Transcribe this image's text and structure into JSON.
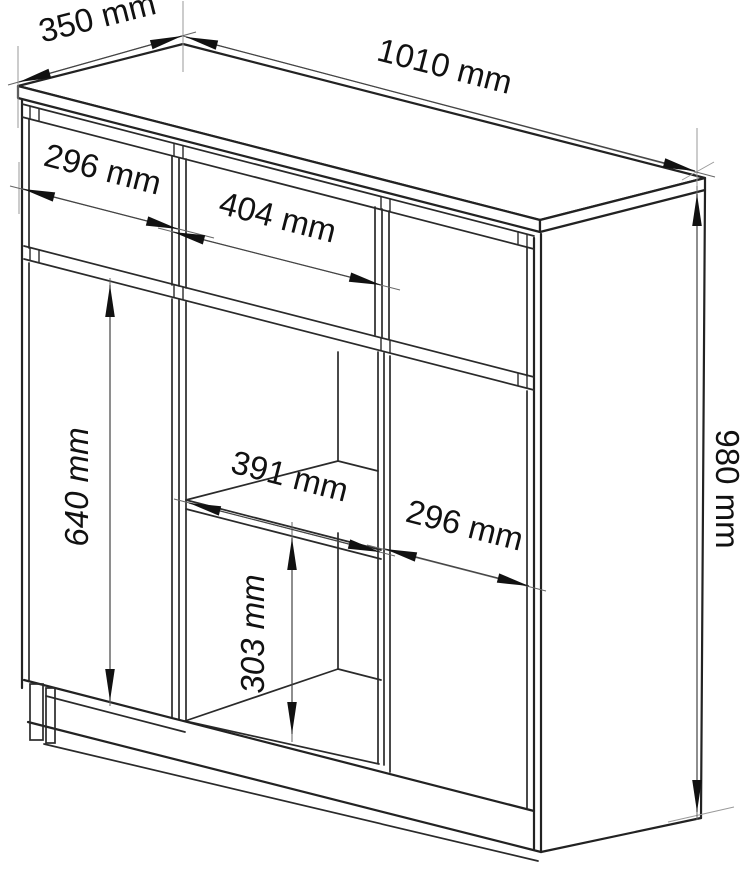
{
  "diagram": {
    "type": "furniture-dimension-drawing",
    "background_color": "#ffffff",
    "line_color": "#222222",
    "arrow_color": "#111111",
    "unit": "mm",
    "dimensions": {
      "top_depth": "350 mm",
      "top_width": "1010 mm",
      "left_drawer_width": "296 mm",
      "middle_drawer_width": "404 mm",
      "left_door_height": "640 mm",
      "shelf_opening_width": "391 mm",
      "right_door_width": "296 mm",
      "lower_opening_height": "303 mm",
      "total_height": "980 mm"
    },
    "dimension_values_mm": {
      "top_depth": 350,
      "top_width": 1010,
      "left_drawer_width": 296,
      "middle_drawer_width": 404,
      "left_door_height": 640,
      "shelf_opening_width": 391,
      "right_door_width": 296,
      "lower_opening_height": 303,
      "total_height": 980
    }
  }
}
